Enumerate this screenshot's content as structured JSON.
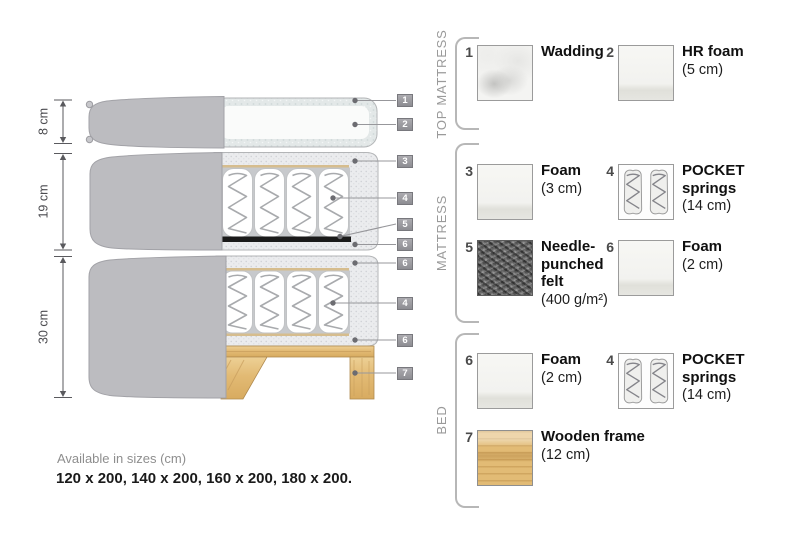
{
  "diagram": {
    "dimensions": [
      {
        "label": "8 cm"
      },
      {
        "label": "19 cm"
      },
      {
        "label": "30 cm"
      }
    ],
    "callouts": [
      "1",
      "2",
      "3",
      "4",
      "5",
      "6",
      "6",
      "4",
      "6",
      "7"
    ]
  },
  "legend": {
    "sections": [
      {
        "title": "TOP MATTRESS",
        "items": [
          {
            "num": "1",
            "name": "Wadding",
            "detail": "",
            "swatch": "wadding-texture"
          },
          {
            "num": "2",
            "name": "HR foam",
            "detail": "(5 cm)",
            "swatch": "foam-texture"
          }
        ]
      },
      {
        "title": "MATTRESS",
        "items": [
          {
            "num": "3",
            "name": "Foam",
            "detail": "(3 cm)",
            "swatch": "foam-texture"
          },
          {
            "num": "4",
            "name": "POCKET\nsprings",
            "detail": "(14 cm)",
            "swatch": "pocket-springs-texture"
          },
          {
            "num": "5",
            "name": "Needle-\npunched\nfelt",
            "detail": "(400 g/m²)",
            "swatch": "felt-texture"
          },
          {
            "num": "6",
            "name": "Foam",
            "detail": "(2 cm)",
            "swatch": "foam-texture"
          }
        ]
      },
      {
        "title": "BED",
        "items": [
          {
            "num": "6",
            "name": "Foam",
            "detail": "(2 cm)",
            "swatch": "foam-texture"
          },
          {
            "num": "4",
            "name": "POCKET\nsprings",
            "detail": "(14 cm)",
            "swatch": "pocket-springs-texture"
          },
          {
            "num": "7",
            "name": "Wooden frame",
            "detail": "(12 cm)",
            "swatch": "wood-texture"
          }
        ]
      }
    ]
  },
  "footer": {
    "sizes_title": "Available in sizes (cm)",
    "sizes_values": "120 x 200, 140 x 200, 160 x 200, 180 x 200."
  },
  "colors": {
    "cover_gray": "#bcbcc0",
    "foam_speckle": "#ebecee",
    "felt_black": "#1a1a1a",
    "wood": "#e2bb75",
    "badge_gray": "#97979b"
  }
}
